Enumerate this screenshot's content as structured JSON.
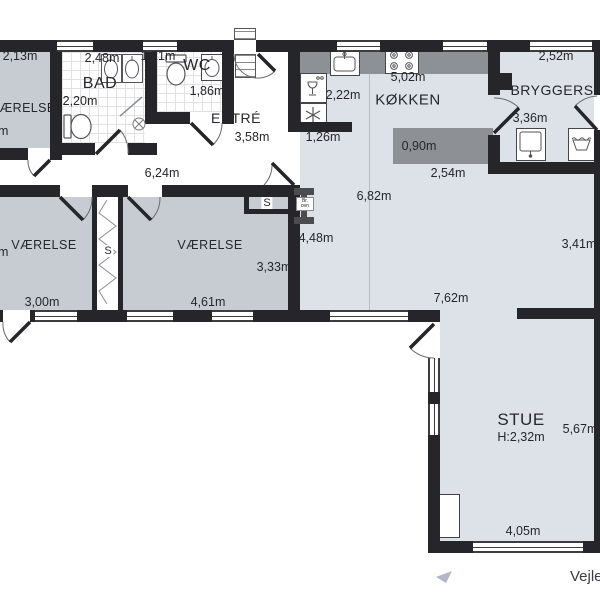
{
  "title": "Floor plan (Danish house)",
  "colors": {
    "wall": "#26262a",
    "room_fill_dark": "#c7ccd3",
    "room_fill_light": "#dde2e8",
    "counter_gray": "#8d9196",
    "text": "#26262b"
  },
  "rooms": {
    "vaerelse_nw": {
      "name": "VÆRELSE",
      "dim_top": "2,13m",
      "dim_left_partial": "m"
    },
    "bad": {
      "name": "BAD",
      "dim_top": "2,48m",
      "dim_inner": "2,20m"
    },
    "wc": {
      "name": "WC",
      "dim_top": "1,21m",
      "dim_inner": "1,86m"
    },
    "entre": {
      "name": "ENTRÉ",
      "dim": "3,58m"
    },
    "hall": {
      "dim": "6,24m"
    },
    "vaerelse_w": {
      "name": "VÆRELSE",
      "dim_bottom": "3,00m",
      "dim_left_partial": "m"
    },
    "vaerelse_m": {
      "name": "VÆRELSE",
      "dim_bottom": "4,61m",
      "dim_right": "3,33m"
    },
    "closet_mid": {
      "label": "S"
    },
    "closet_ne": {
      "label": "S"
    },
    "koekken": {
      "name": "KØKKEN",
      "dim_top": "5,02m",
      "dim_left": "2,22m",
      "dim_lower_left": "1,26m",
      "island_depth": "0,90m",
      "island_width": "2,54m"
    },
    "bryggers": {
      "name": "BRYGGERS",
      "dim_top": "2,52m",
      "dim_inner": "3,36m"
    },
    "living_open": {
      "dim_vertical": "6,82m",
      "dim_left": "4,48m",
      "dim_right": "3,41m",
      "dim_width": "7,62m"
    },
    "stue": {
      "name": "STUE",
      "ceiling_height": "H:2,32m",
      "dim_right": "5,67m",
      "dim_bottom": "4,05m"
    },
    "woodstove": {
      "label_line1": "Br.",
      "label_line2": "ovn"
    }
  },
  "footer": {
    "watermark": "Vejle"
  },
  "icons": [
    "kitchen-sink-icon",
    "stove-icon",
    "fridge-icon",
    "freezer-icon",
    "bryggers-sink-icon",
    "laundry-tub-icon",
    "basin-icon",
    "toilet-icon",
    "floor-drain-icon",
    "wood-stove-icon",
    "cursor-arrow-icon"
  ]
}
